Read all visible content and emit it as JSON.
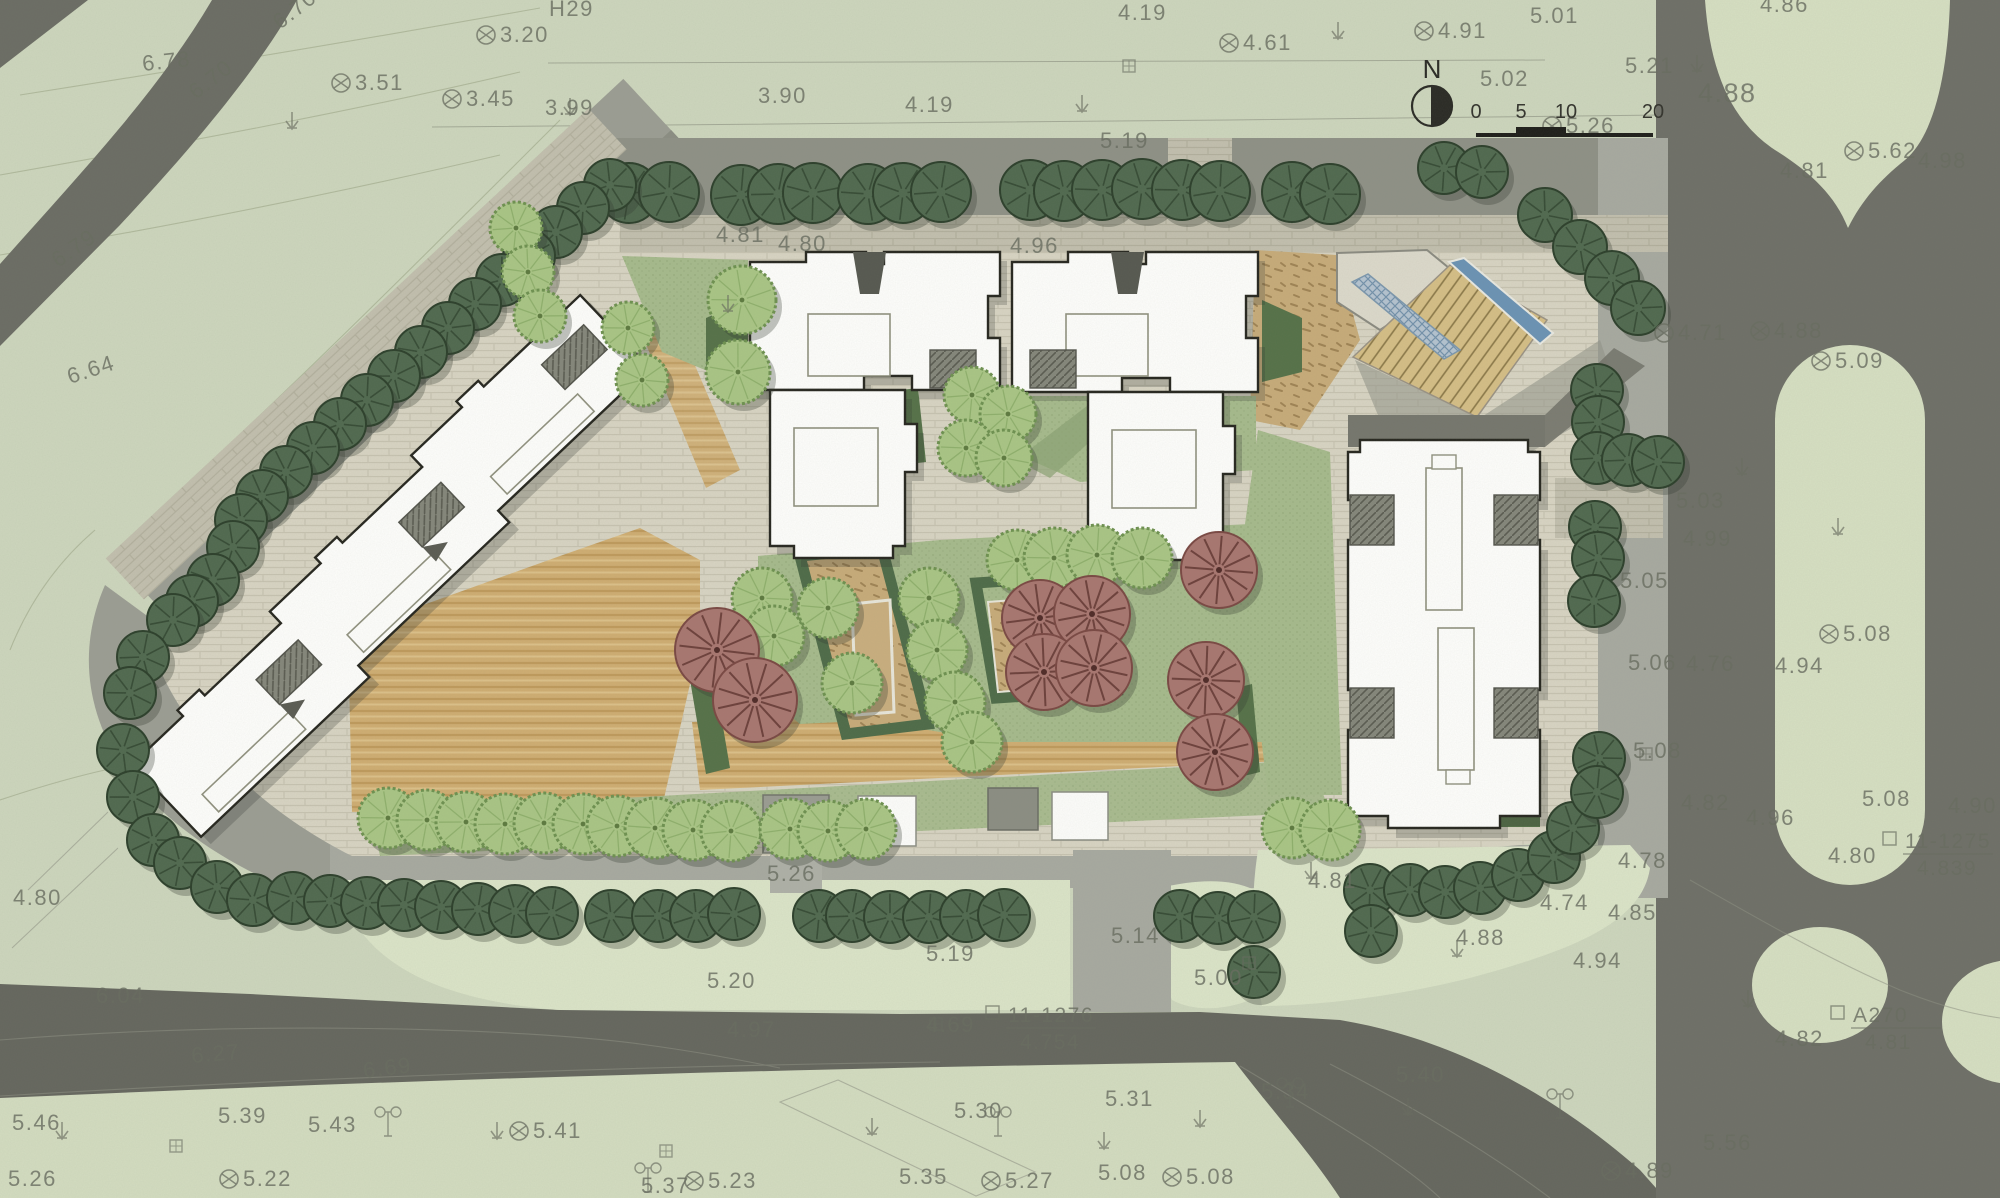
{
  "meta": {
    "drawing_type": "residential site plan"
  },
  "north": {
    "label": "N"
  },
  "scale_bar": {
    "t0": "0",
    "t1": "5",
    "t2": "10",
    "t3": "20"
  },
  "colors": {
    "background": "#cdd6bd",
    "road": "#6b6c64",
    "road_dark": "#63645c",
    "sidewalk": "#a7a9a0",
    "shadow_band": "#8e9086",
    "paving": "#d8d4c3",
    "sand": "#cfad72",
    "lawn": "#a6ba8c",
    "hedge": "#557148",
    "building_fill": "#fefefc",
    "building_line": "#26261f",
    "tree_dark": "#50694f",
    "tree_light": "#a9c585",
    "tree_maroon": "#a87670",
    "water": "#6b92b4",
    "label_gray": "#686c60"
  },
  "elevation_labels": [
    {
      "x": 143,
      "y": 71,
      "t": "6.78",
      "r": -6
    },
    {
      "x": 280,
      "y": 30,
      "t": "6.70",
      "r": -38
    },
    {
      "x": 196,
      "y": 100,
      "t": "6.70",
      "r": -38
    },
    {
      "x": 58,
      "y": 268,
      "t": "6.79",
      "r": -35
    },
    {
      "x": 70,
      "y": 384,
      "t": "6.64",
      "r": -18
    },
    {
      "x": 355,
      "y": 90,
      "t": "3.51",
      "m": 1
    },
    {
      "x": 500,
      "y": 42,
      "t": "3.20",
      "m": 1
    },
    {
      "x": 466,
      "y": 106,
      "t": "3.45",
      "m": 1
    },
    {
      "x": 545,
      "y": 115,
      "t": "3.99"
    },
    {
      "x": 549,
      "y": 16,
      "t": "H29"
    },
    {
      "x": 758,
      "y": 103,
      "t": "3.90"
    },
    {
      "x": 905,
      "y": 112,
      "t": "4.19"
    },
    {
      "x": 1118,
      "y": 20,
      "t": "4.19"
    },
    {
      "x": 1243,
      "y": 50,
      "t": "4.61",
      "m": 1
    },
    {
      "x": 1100,
      "y": 148,
      "t": "5.19"
    },
    {
      "x": 716,
      "y": 242,
      "t": "4.81"
    },
    {
      "x": 778,
      "y": 251,
      "t": "4.80"
    },
    {
      "x": 1010,
      "y": 253,
      "t": "4.96"
    },
    {
      "x": 1530,
      "y": 23,
      "t": "5.01"
    },
    {
      "x": 1438,
      "y": 38,
      "t": "4.91",
      "m": 1
    },
    {
      "x": 1480,
      "y": 86,
      "t": "5.02"
    },
    {
      "x": 1625,
      "y": 73,
      "t": "5.21"
    },
    {
      "x": 1760,
      "y": 12,
      "t": "4.86"
    },
    {
      "x": 1698,
      "y": 102,
      "t": "4.88",
      "s": 27
    },
    {
      "x": 1566,
      "y": 133,
      "t": "5.26",
      "m": 1
    },
    {
      "x": 1868,
      "y": 158,
      "t": "5.62",
      "m": 1
    },
    {
      "x": 1918,
      "y": 168,
      "t": "4.98"
    },
    {
      "x": 1780,
      "y": 178,
      "t": "4.81"
    },
    {
      "x": 1678,
      "y": 340,
      "t": "4.71",
      "m": 1
    },
    {
      "x": 1774,
      "y": 338,
      "t": "4.88",
      "m": 1
    },
    {
      "x": 1835,
      "y": 368,
      "t": "5.09",
      "m": 1
    },
    {
      "x": 1676,
      "y": 508,
      "t": "5.03"
    },
    {
      "x": 1683,
      "y": 546,
      "t": "4.99"
    },
    {
      "x": 1620,
      "y": 588,
      "t": "5.05"
    },
    {
      "x": 1843,
      "y": 641,
      "t": "5.08",
      "m": 1
    },
    {
      "x": 1628,
      "y": 670,
      "t": "5.06"
    },
    {
      "x": 1686,
      "y": 671,
      "t": "4.76"
    },
    {
      "x": 1775,
      "y": 673,
      "t": "4.94"
    },
    {
      "x": 1633,
      "y": 758,
      "t": "5.08"
    },
    {
      "x": 1681,
      "y": 810,
      "t": "4.82"
    },
    {
      "x": 1746,
      "y": 825,
      "t": "4.96"
    },
    {
      "x": 1862,
      "y": 806,
      "t": "5.08"
    },
    {
      "x": 1948,
      "y": 813,
      "t": "4.90"
    },
    {
      "x": 1828,
      "y": 863,
      "t": "4.80"
    },
    {
      "x": 1618,
      "y": 868,
      "t": "4.78"
    },
    {
      "x": 1608,
      "y": 920,
      "t": "4.85"
    },
    {
      "x": 1775,
      "y": 1046,
      "t": "4.82"
    },
    {
      "x": 1703,
      "y": 1150,
      "t": "5.56"
    },
    {
      "x": 1625,
      "y": 1178,
      "t": "4.89",
      "m": 1
    },
    {
      "x": 767,
      "y": 881,
      "t": "5.26"
    },
    {
      "x": 926,
      "y": 961,
      "t": "5.19"
    },
    {
      "x": 707,
      "y": 988,
      "t": "5.20"
    },
    {
      "x": 727,
      "y": 1037,
      "t": "4.97"
    },
    {
      "x": 926,
      "y": 1032,
      "t": "4.69"
    },
    {
      "x": 1111,
      "y": 943,
      "t": "5.14"
    },
    {
      "x": 1194,
      "y": 985,
      "t": "5.00"
    },
    {
      "x": 1308,
      "y": 888,
      "t": "4.81"
    },
    {
      "x": 1456,
      "y": 945,
      "t": "4.88"
    },
    {
      "x": 1540,
      "y": 910,
      "t": "4.74"
    },
    {
      "x": 1573,
      "y": 968,
      "t": "4.94"
    },
    {
      "x": 96,
      "y": 1003,
      "t": "6.04"
    },
    {
      "x": 192,
      "y": 1063,
      "t": "6.27",
      "r": -5
    },
    {
      "x": 364,
      "y": 1078,
      "t": "6.69",
      "r": -7
    },
    {
      "x": 12,
      "y": 1130,
      "t": "5.46"
    },
    {
      "x": 218,
      "y": 1123,
      "t": "5.39"
    },
    {
      "x": 308,
      "y": 1132,
      "t": "5.43"
    },
    {
      "x": 533,
      "y": 1138,
      "t": "5.41",
      "m": 1
    },
    {
      "x": 954,
      "y": 1118,
      "t": "5.30"
    },
    {
      "x": 1105,
      "y": 1106,
      "t": "5.31"
    },
    {
      "x": 1261,
      "y": 1099,
      "t": "5.34"
    },
    {
      "x": 899,
      "y": 1184,
      "t": "5.35"
    },
    {
      "x": 1005,
      "y": 1188,
      "t": "5.27",
      "m": 1
    },
    {
      "x": 1098,
      "y": 1180,
      "t": "5.08"
    },
    {
      "x": 1186,
      "y": 1184,
      "t": "5.08",
      "m": 1
    },
    {
      "x": 8,
      "y": 1186,
      "t": "5.26"
    },
    {
      "x": 243,
      "y": 1186,
      "t": "5.22",
      "m": 1
    },
    {
      "x": 708,
      "y": 1188,
      "t": "5.23",
      "m": 1
    },
    {
      "x": 641,
      "y": 1193,
      "t": "5.37"
    },
    {
      "x": 1396,
      "y": 1082,
      "t": "5.40"
    },
    {
      "x": 13,
      "y": 905,
      "t": "4.80"
    }
  ],
  "benchmarks": [
    {
      "x": 1048,
      "y": 1022,
      "top": "11-1276",
      "bottom": "4.754"
    },
    {
      "x": 1945,
      "y": 848,
      "top": "11-1275",
      "bottom": "4.839"
    },
    {
      "x": 1893,
      "y": 1022,
      "top": "A270",
      "bottom": "4.81"
    }
  ],
  "symbols": {
    "arrows": [
      [
        292,
        112
      ],
      [
        570,
        98
      ],
      [
        728,
        295
      ],
      [
        1082,
        95
      ],
      [
        1338,
        22
      ],
      [
        1697,
        55
      ],
      [
        1742,
        458
      ],
      [
        1748,
        990
      ],
      [
        1838,
        518
      ],
      [
        62,
        1122
      ],
      [
        497,
        1122
      ],
      [
        1104,
        1132
      ],
      [
        1200,
        1110
      ],
      [
        1408,
        1098
      ],
      [
        872,
        1118
      ],
      [
        1311,
        862
      ],
      [
        1457,
        940
      ]
    ],
    "poles": [
      [
        388,
        1122
      ],
      [
        998,
        1122
      ],
      [
        648,
        1178
      ],
      [
        1290,
        1093
      ],
      [
        1560,
        1104
      ]
    ],
    "squares": [
      [
        170,
        1140
      ],
      [
        660,
        1145
      ],
      [
        1243,
        957
      ],
      [
        1640,
        748
      ],
      [
        930,
        1018
      ],
      [
        1123,
        60
      ]
    ]
  },
  "trees": {
    "dark": [
      [
        629,
        193,
        30
      ],
      [
        669,
        192,
        30
      ],
      [
        741,
        195,
        30
      ],
      [
        778,
        194,
        30
      ],
      [
        813,
        193,
        30
      ],
      [
        868,
        194,
        30
      ],
      [
        903,
        193,
        30
      ],
      [
        941,
        192,
        30
      ],
      [
        1030,
        190,
        30
      ],
      [
        1064,
        191,
        30
      ],
      [
        1102,
        190,
        30
      ],
      [
        1142,
        189,
        30
      ],
      [
        1182,
        190,
        30
      ],
      [
        1220,
        191,
        30
      ],
      [
        1292,
        192,
        30
      ],
      [
        1330,
        194,
        30
      ],
      [
        1444,
        168,
        26
      ],
      [
        1482,
        172,
        26
      ],
      [
        1545,
        215,
        27
      ],
      [
        1580,
        247,
        27
      ],
      [
        1612,
        278,
        27
      ],
      [
        1638,
        308,
        27
      ],
      [
        610,
        185,
        26
      ],
      [
        583,
        208,
        26
      ],
      [
        556,
        232,
        26
      ],
      [
        529,
        256,
        26
      ],
      [
        502,
        280,
        26
      ],
      [
        475,
        304,
        26
      ],
      [
        448,
        328,
        26
      ],
      [
        421,
        352,
        26
      ],
      [
        394,
        376,
        26
      ],
      [
        367,
        400,
        26
      ],
      [
        340,
        424,
        26
      ],
      [
        313,
        448,
        26
      ],
      [
        286,
        472,
        26
      ],
      [
        262,
        496,
        26
      ],
      [
        241,
        520,
        26
      ],
      [
        233,
        547,
        26
      ],
      [
        213,
        580,
        26
      ],
      [
        192,
        601,
        26
      ],
      [
        173,
        620,
        26
      ],
      [
        143,
        657,
        26
      ],
      [
        130,
        693,
        26
      ],
      [
        123,
        750,
        26
      ],
      [
        133,
        797,
        26
      ],
      [
        153,
        840,
        26
      ],
      [
        180,
        863,
        26
      ],
      [
        217,
        887,
        26
      ],
      [
        253,
        900,
        26
      ],
      [
        293,
        898,
        26
      ],
      [
        330,
        901,
        26
      ],
      [
        367,
        903,
        26
      ],
      [
        404,
        905,
        26
      ],
      [
        441,
        907,
        26
      ],
      [
        478,
        909,
        26
      ],
      [
        515,
        911,
        26
      ],
      [
        552,
        913,
        26
      ],
      [
        611,
        916,
        26
      ],
      [
        658,
        916,
        26
      ],
      [
        696,
        916,
        26
      ],
      [
        734,
        914,
        26
      ],
      [
        819,
        916,
        26
      ],
      [
        852,
        916,
        26
      ],
      [
        890,
        917,
        26
      ],
      [
        929,
        917,
        26
      ],
      [
        966,
        916,
        26
      ],
      [
        1004,
        915,
        26
      ],
      [
        1180,
        916,
        26
      ],
      [
        1218,
        918,
        26
      ],
      [
        1254,
        917,
        26
      ],
      [
        1254,
        972,
        26
      ],
      [
        1370,
        890,
        26
      ],
      [
        1410,
        890,
        26
      ],
      [
        1445,
        892,
        26
      ],
      [
        1480,
        888,
        26
      ],
      [
        1518,
        875,
        26
      ],
      [
        1554,
        857,
        26
      ],
      [
        1573,
        828,
        26
      ],
      [
        1371,
        931,
        26
      ],
      [
        1597,
        390,
        26
      ],
      [
        1598,
        422,
        26
      ],
      [
        1597,
        458,
        26
      ],
      [
        1628,
        460,
        26
      ],
      [
        1658,
        462,
        26
      ],
      [
        1595,
        527,
        26
      ],
      [
        1598,
        558,
        26
      ],
      [
        1594,
        601,
        26
      ],
      [
        1599,
        758,
        26
      ],
      [
        1597,
        792,
        26
      ]
    ],
    "light": [
      [
        516,
        228,
        26
      ],
      [
        528,
        272,
        26
      ],
      [
        540,
        316,
        26
      ],
      [
        628,
        328,
        26
      ],
      [
        642,
        380,
        26
      ],
      [
        742,
        300,
        34
      ],
      [
        738,
        372,
        32
      ],
      [
        972,
        395,
        28
      ],
      [
        1008,
        414,
        28
      ],
      [
        966,
        448,
        28
      ],
      [
        1004,
        458,
        28
      ],
      [
        1017,
        560,
        30
      ],
      [
        1054,
        558,
        30
      ],
      [
        1097,
        555,
        30
      ],
      [
        1142,
        558,
        30
      ],
      [
        762,
        598,
        30
      ],
      [
        774,
        636,
        30
      ],
      [
        828,
        608,
        30
      ],
      [
        852,
        683,
        30
      ],
      [
        929,
        598,
        30
      ],
      [
        937,
        650,
        30
      ],
      [
        955,
        702,
        30
      ],
      [
        972,
        742,
        30
      ],
      [
        388,
        818,
        30
      ],
      [
        427,
        820,
        30
      ],
      [
        466,
        822,
        30
      ],
      [
        505,
        824,
        30
      ],
      [
        544,
        823,
        30
      ],
      [
        583,
        824,
        30
      ],
      [
        617,
        826,
        30
      ],
      [
        655,
        828,
        30
      ],
      [
        693,
        830,
        30
      ],
      [
        731,
        831,
        30
      ],
      [
        790,
        829,
        30
      ],
      [
        828,
        831,
        30
      ],
      [
        866,
        829,
        30
      ],
      [
        1292,
        828,
        30
      ],
      [
        1330,
        830,
        30
      ]
    ],
    "maroon": [
      [
        717,
        650,
        42
      ],
      [
        755,
        700,
        42
      ],
      [
        1040,
        618,
        38
      ],
      [
        1092,
        614,
        38
      ],
      [
        1044,
        672,
        38
      ],
      [
        1094,
        668,
        38
      ],
      [
        1219,
        570,
        38
      ],
      [
        1206,
        680,
        38
      ],
      [
        1215,
        752,
        38
      ]
    ]
  }
}
